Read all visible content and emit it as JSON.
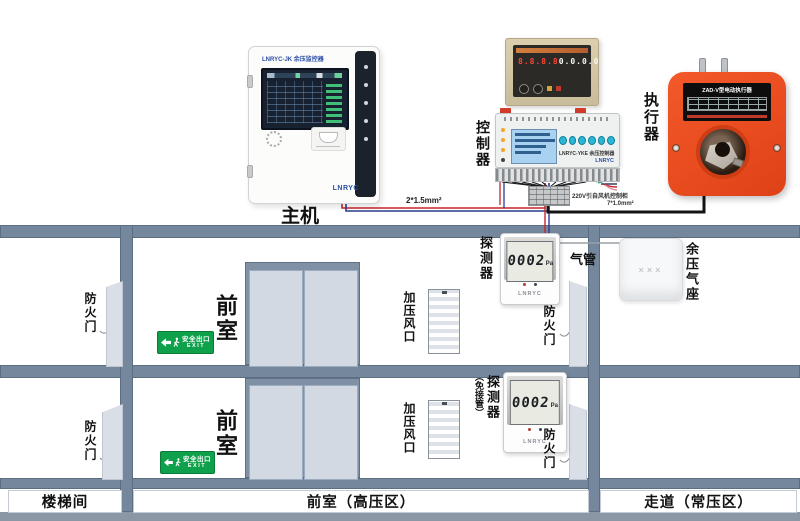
{
  "host": {
    "label": "主机",
    "header": "LNRYC-JK 余压监控器",
    "brand": "LNRYC"
  },
  "controller": {
    "label": "控制器",
    "model": "LNRYC-YKE 余压控制器",
    "brand": "LNRYC",
    "display_left": "8.8.8.8",
    "display_right": "0.0.0.0"
  },
  "actuator": {
    "label": "执行器",
    "title": "ZAD-V型电动执行器"
  },
  "wiring": {
    "host_cable": "2*1.5mm²",
    "power_note": "220V引自风机控制柜",
    "actuator_cable": "7*1.0mm²"
  },
  "detector1": {
    "label": "探测器",
    "value": "0002",
    "unit": "Pa",
    "brand": "LNRYC"
  },
  "detector2": {
    "label": "探测器",
    "sublabel": "（免接管）",
    "value": "0002",
    "unit": "Pa",
    "brand": "LNRYC"
  },
  "tube": {
    "label": "气管"
  },
  "airseat": {
    "label": "余压气座",
    "pattern": "×××"
  },
  "rooms": {
    "front_room": "前室",
    "fire_door": "防火门",
    "vent": "加压风口"
  },
  "exit_sign": {
    "text": "安全出口",
    "sub": "EXIT"
  },
  "zones": {
    "stairwell": "楼梯间",
    "front_high": "前室（高压区）",
    "corridor_normal": "走道（常压区）"
  }
}
